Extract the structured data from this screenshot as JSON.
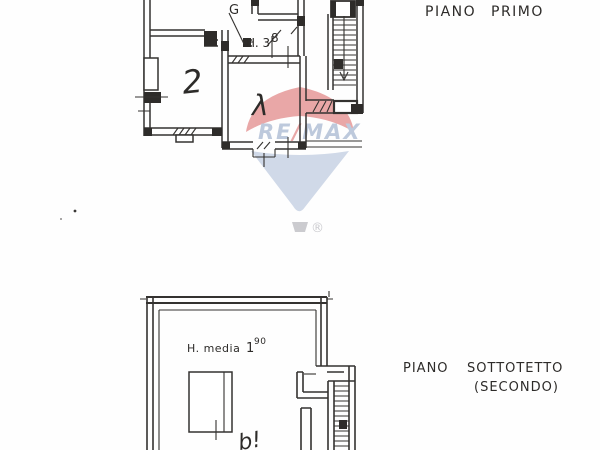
{
  "document": {
    "type": "floor-plan-sheet",
    "ink_color": "#343230",
    "background": "#fefefe"
  },
  "annotations": {
    "floor1": {
      "word1": "PIANO",
      "word2": "PRIMO"
    },
    "floor2": {
      "word1": "PIANO",
      "word2": "SOTTOTETTO",
      "line2": "(SECONDO)"
    },
    "heights": {
      "first": {
        "label": "H. 3",
        "sup": "8"
      },
      "attic": {
        "label": "H. media",
        "value": "1",
        "sup": "90"
      }
    },
    "room_marks": {
      "left": "2",
      "center": "λ",
      "top": "G",
      "attic": "b!"
    }
  },
  "watermark": {
    "re": "RE",
    "slash": "/",
    "max": "MAX",
    "registered": "®",
    "colors": {
      "red": "#e79e9e",
      "fan_blue": "#ccd6e6",
      "text_blue": "#b7c4d9",
      "basket_gray": "#c6c6cb"
    }
  }
}
